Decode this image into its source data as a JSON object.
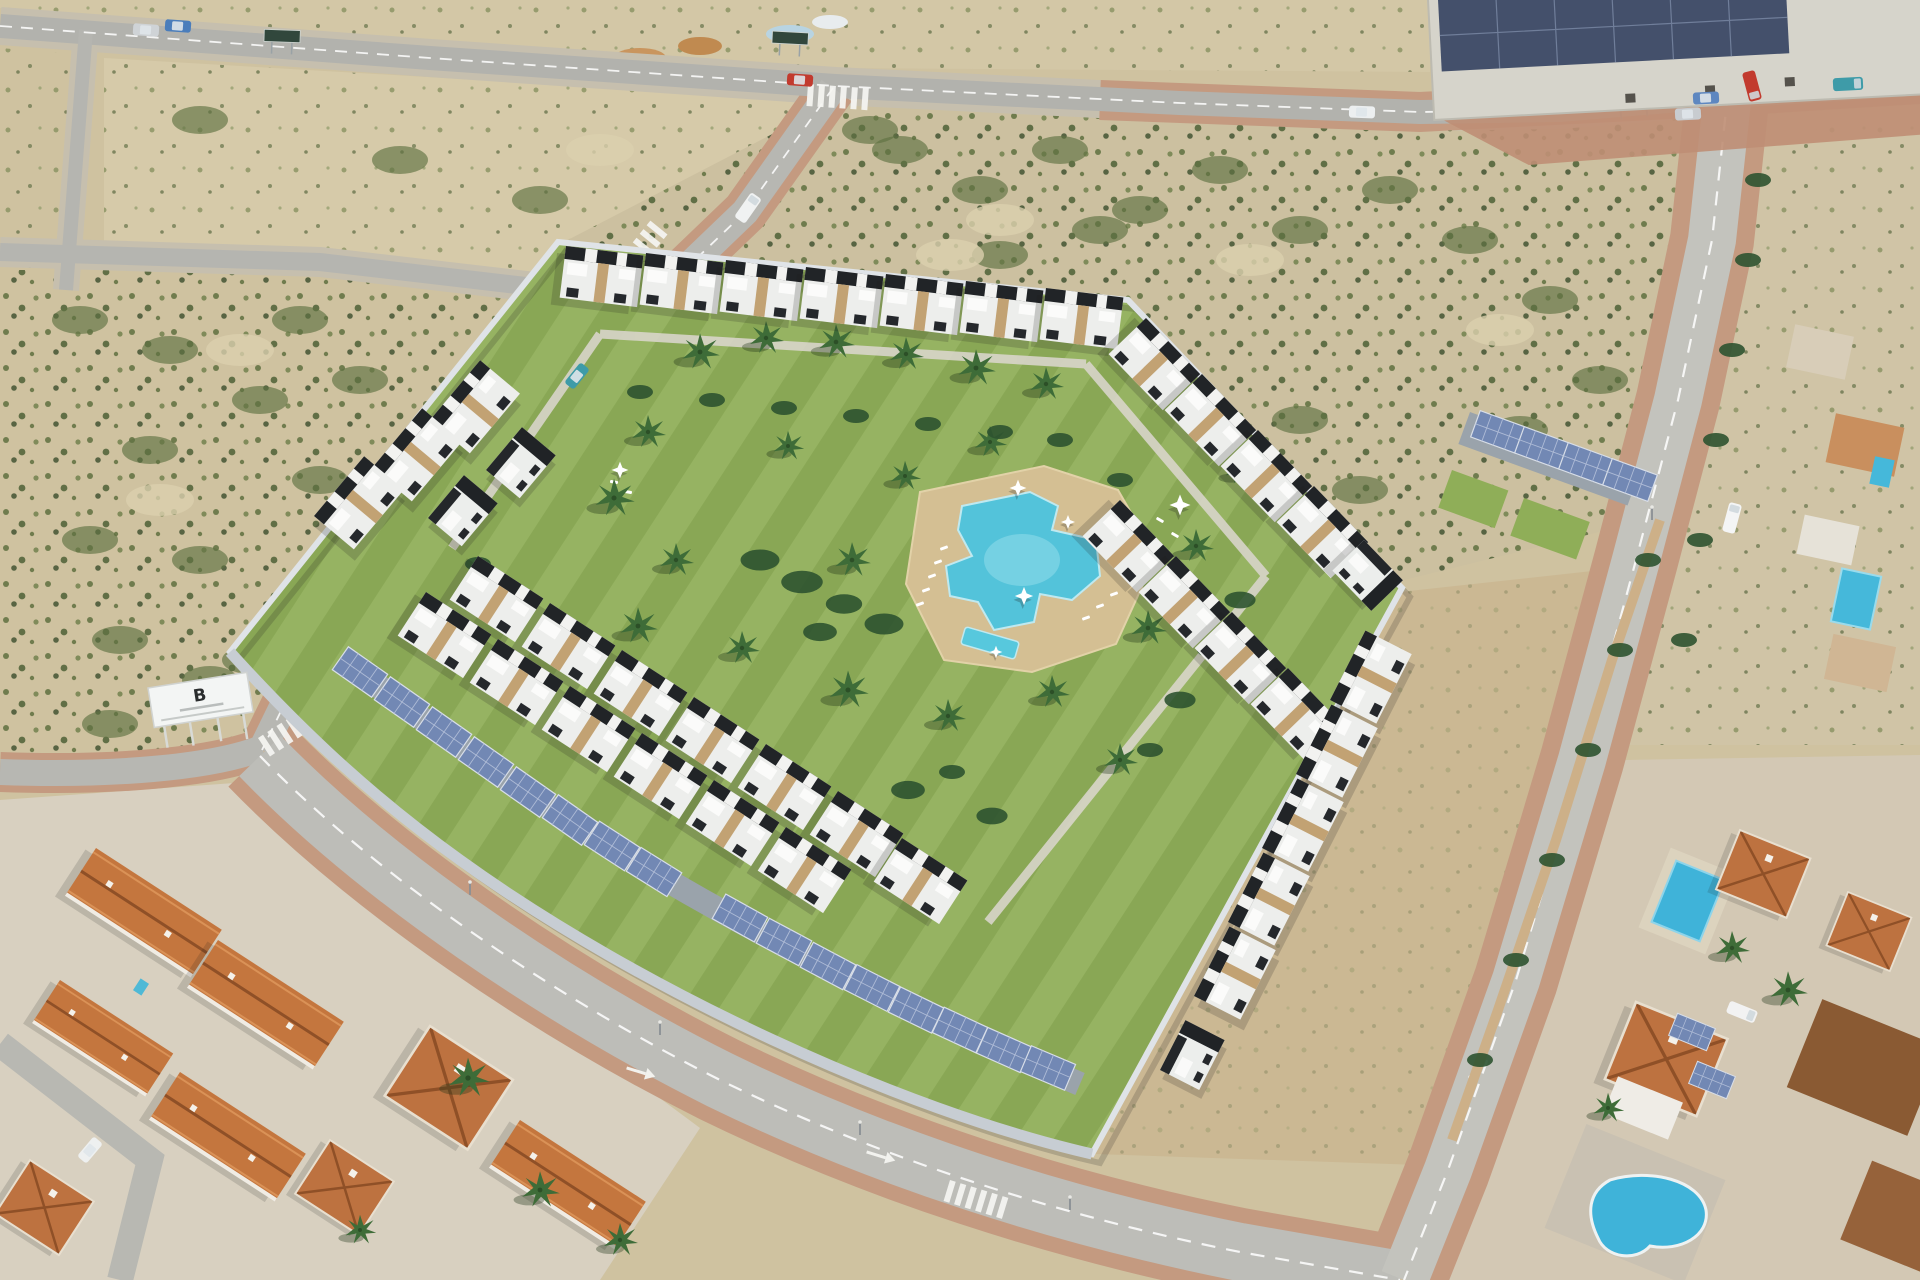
{
  "meta": {
    "title": "Aerial photograph of a new-build residential development with communal gardens and pool",
    "type": "aerial-photograph",
    "width_px": 1920,
    "height_px": 1280
  },
  "billboard": {
    "logo": "B"
  },
  "palette": {
    "sand": "#cfc2a0",
    "scrub_green": "#5f7242",
    "lawn_green": "#8fae58",
    "pool_blue": "#53c3da",
    "deck_tan": "#d4bf93",
    "asphalt_gray": "#b8b8b2",
    "sidewalk_clay": "#c49a80",
    "facade_white": "#edeeec",
    "pergola_black": "#212427",
    "stone_accent": "#c2a273",
    "solar_panel_blue": "#7288b4",
    "terracotta_roof": "#c4763e",
    "dark_brown_roof": "#8a5a33",
    "perimeter_wall": "#dfe3e7",
    "embankment_tan": "#cbb893",
    "warehouse_solar": "#44506b"
  },
  "scene": {
    "development": {
      "label": "Modern white townhouse complex with black pergola roofs",
      "garden": {
        "label": "Central communal garden",
        "palm_trees": 22,
        "shrub_beds": 6
      },
      "pool": {
        "label": "Freeform communal swimming pool",
        "kids_pool": true,
        "sun_loungers": 12,
        "parasols": 5
      },
      "housing_rows": [
        "north terrace row",
        "north-east terrace row",
        "east inner terrace row",
        "south-east wing terraces",
        "south-west inner terrace row",
        "south-west outer terrace row",
        "north-west corner houses"
      ],
      "carports": {
        "label": "Solar-panel carports",
        "locations": [
          "south-west boundary",
          "north-east corner"
        ],
        "panels_southwest": 16,
        "panels_northeast": 4
      }
    },
    "roads": [
      "top east-west road",
      "left service road",
      "left cross street",
      "north-west diagonal avenue",
      "south-west boulevard",
      "eastern bypass road",
      "old-town side street"
    ],
    "crosswalks": 4,
    "vehicles": [
      {
        "label": "silver car",
        "location": "top east-west road"
      },
      {
        "label": "blue car",
        "location": "top east-west road"
      },
      {
        "label": "red car",
        "location": "top intersection"
      },
      {
        "label": "white car",
        "location": "top east-west road east"
      },
      {
        "label": "silver car",
        "location": "top-right intersection"
      },
      {
        "label": "blue car",
        "location": "top-right intersection"
      },
      {
        "label": "red truck",
        "location": "top-right intersection"
      },
      {
        "label": "teal truck",
        "location": "warehouse yard"
      },
      {
        "label": "white van",
        "location": "north-west diagonal avenue"
      },
      {
        "label": "teal car",
        "location": "north-west diagonal avenue"
      },
      {
        "label": "white van",
        "location": "eastern bypass road"
      },
      {
        "label": "white van",
        "location": "east villa driveway"
      },
      {
        "label": "white car",
        "location": "old-town side street"
      }
    ],
    "surroundings": {
      "north": "Vacant scrubland plots crossed by new roads",
      "north_east": "Industrial warehouse with rooftop solar array and clay-paved apron",
      "west": "Scrubland with developer billboard",
      "south_west": "Established terracotta-roofed townhouses",
      "east": "Terracotta villas with private pools (rectangular and kidney-shaped) and rooftop solar panels"
    }
  }
}
